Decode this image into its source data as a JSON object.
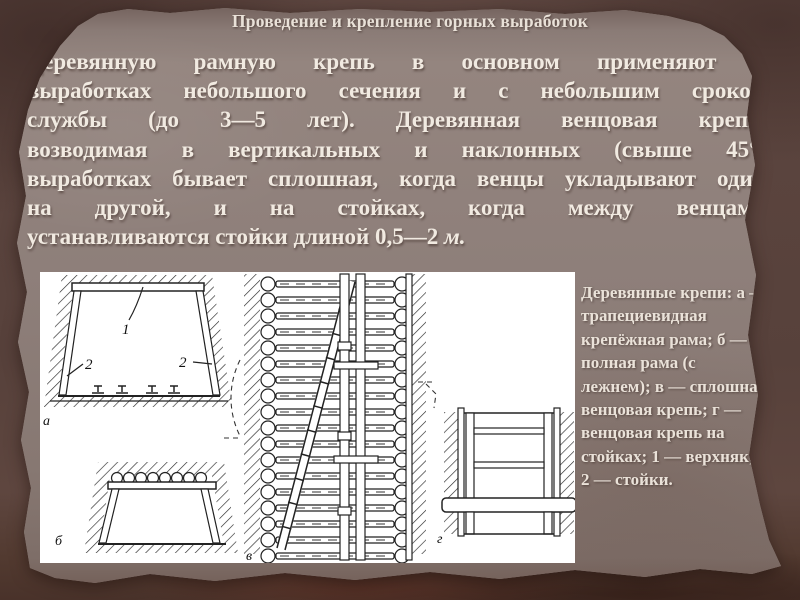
{
  "slide": {
    "title": "Проведение и крепление горных выработок",
    "body_lines": [
      "Деревянную рамную крепь в основном применяют в",
      "выработках небольшого сечения и с небольшим сроком",
      "службы (до 3—5 лет). Деревянная венцовая крепь,",
      "возводимая в вертикальных и наклонных (свыше 45°)",
      "выработках бывает сплошная, когда венцы укладывают один",
      "на другой, и на стойках, когда между венцами"
    ],
    "body_last": "устанавливаются стойки длиной 0,5—2 ",
    "body_unit": "м.",
    "caption": "Деревянные крепи: а — трапециевидная крепёжная рама; б — полная рама (с лежнем); в — сплошная венцовая крепь; г — венцовая крепь на стойках; 1 — верхняк; 2 — стойки.",
    "figure": {
      "label_a": "а",
      "label_b": "б",
      "label_v": "в",
      "label_g": "г",
      "callout_1": "1",
      "callout_2": "2"
    },
    "colors": {
      "background": "#56403a",
      "paper": "#8b7d78",
      "text_light": "#f1eae1",
      "figure_background": "#ffffff",
      "drawing_ink": "#222222"
    }
  }
}
